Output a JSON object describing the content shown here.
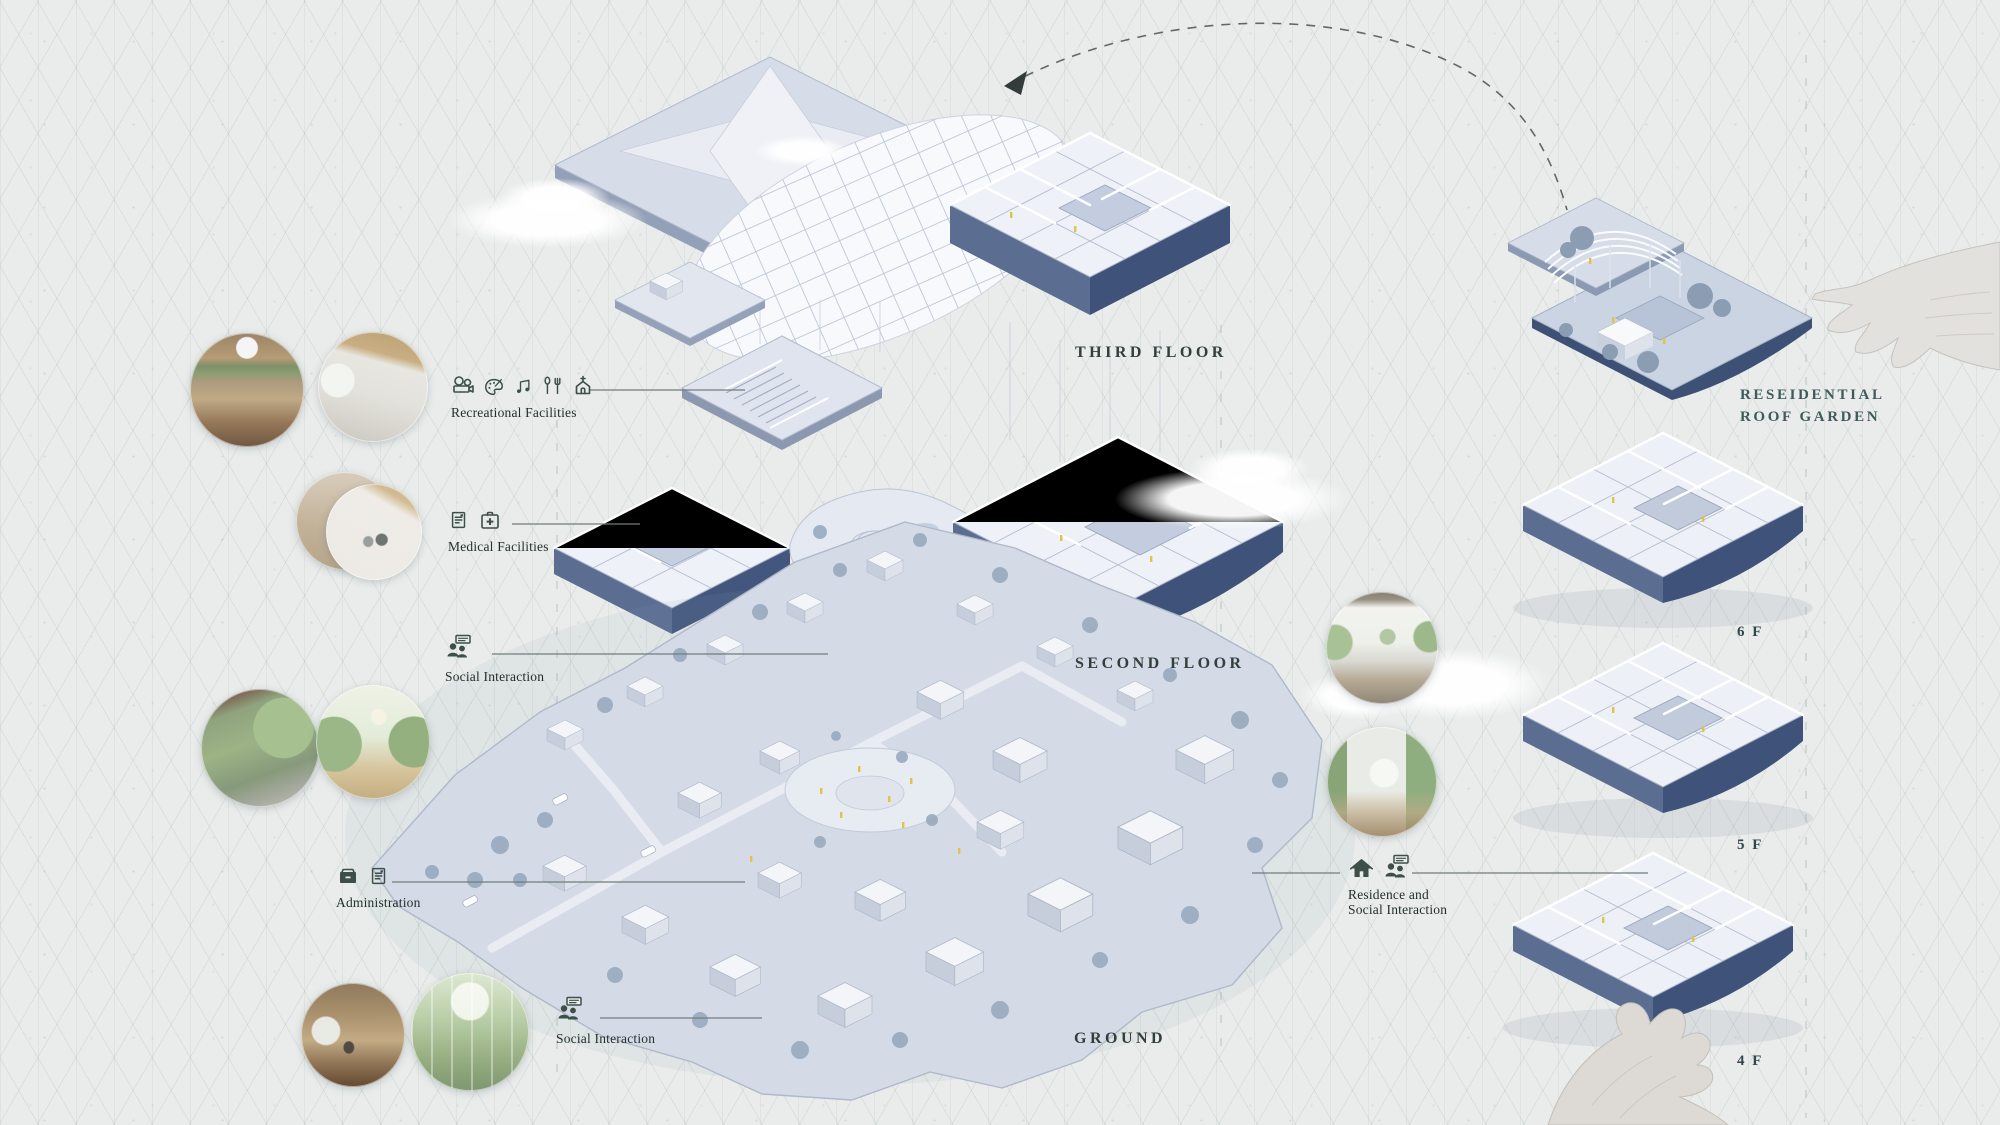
{
  "palette": {
    "background": "#e9ecea",
    "plate_light": "#eef1f7",
    "plate_mid": "#d6dce8",
    "fascia_dark": "#3f537a",
    "fascia_mid": "#5b6e92",
    "tree_blue": "#96a8be",
    "accent_yellow": "#e3c24c",
    "title_text": "#333f3d",
    "stack_text": "#3e5a5a",
    "leader_line": "#707d7a"
  },
  "floors": {
    "third": "THIRD FLOOR",
    "second": "SECOND FLOOR",
    "ground": "GROUND"
  },
  "stack": {
    "roof_line1": "RESEIDENTIAL",
    "roof_line2": "ROOF GARDEN",
    "levels": [
      {
        "label": "6 F"
      },
      {
        "label": "5 F"
      },
      {
        "label": "4 F"
      }
    ]
  },
  "legend_left": [
    {
      "label": "Recreational Facilities",
      "icons": [
        "projector-icon",
        "palette-icon",
        "music-notes-icon",
        "dining-icon",
        "chapel-icon"
      ]
    },
    {
      "label": "Medical Facilities",
      "icons": [
        "medical-report-icon",
        "first-aid-kit-icon"
      ]
    },
    {
      "label": "Social Interaction",
      "icons": [
        "people-conversation-icon"
      ]
    },
    {
      "label": "Administration",
      "icons": [
        "archive-drawer-icon",
        "document-icon"
      ]
    },
    {
      "label": "Social Interaction",
      "icons": [
        "people-conversation-icon"
      ]
    }
  ],
  "legend_right": {
    "line1": "Residence and",
    "line2": "Social Interaction",
    "icons": [
      "house-icon",
      "people-conversation-icon"
    ]
  },
  "photos": [
    {
      "name": "music-room-render"
    },
    {
      "name": "gallery-render"
    },
    {
      "name": "clinic-corridor-render"
    },
    {
      "name": "clinic-render"
    },
    {
      "name": "courtyard-entrance-render"
    },
    {
      "name": "lantern-garden-render"
    },
    {
      "name": "wood-lounge-render"
    },
    {
      "name": "greenhouse-render"
    },
    {
      "name": "living-room-render"
    },
    {
      "name": "bedroom-render"
    }
  ]
}
